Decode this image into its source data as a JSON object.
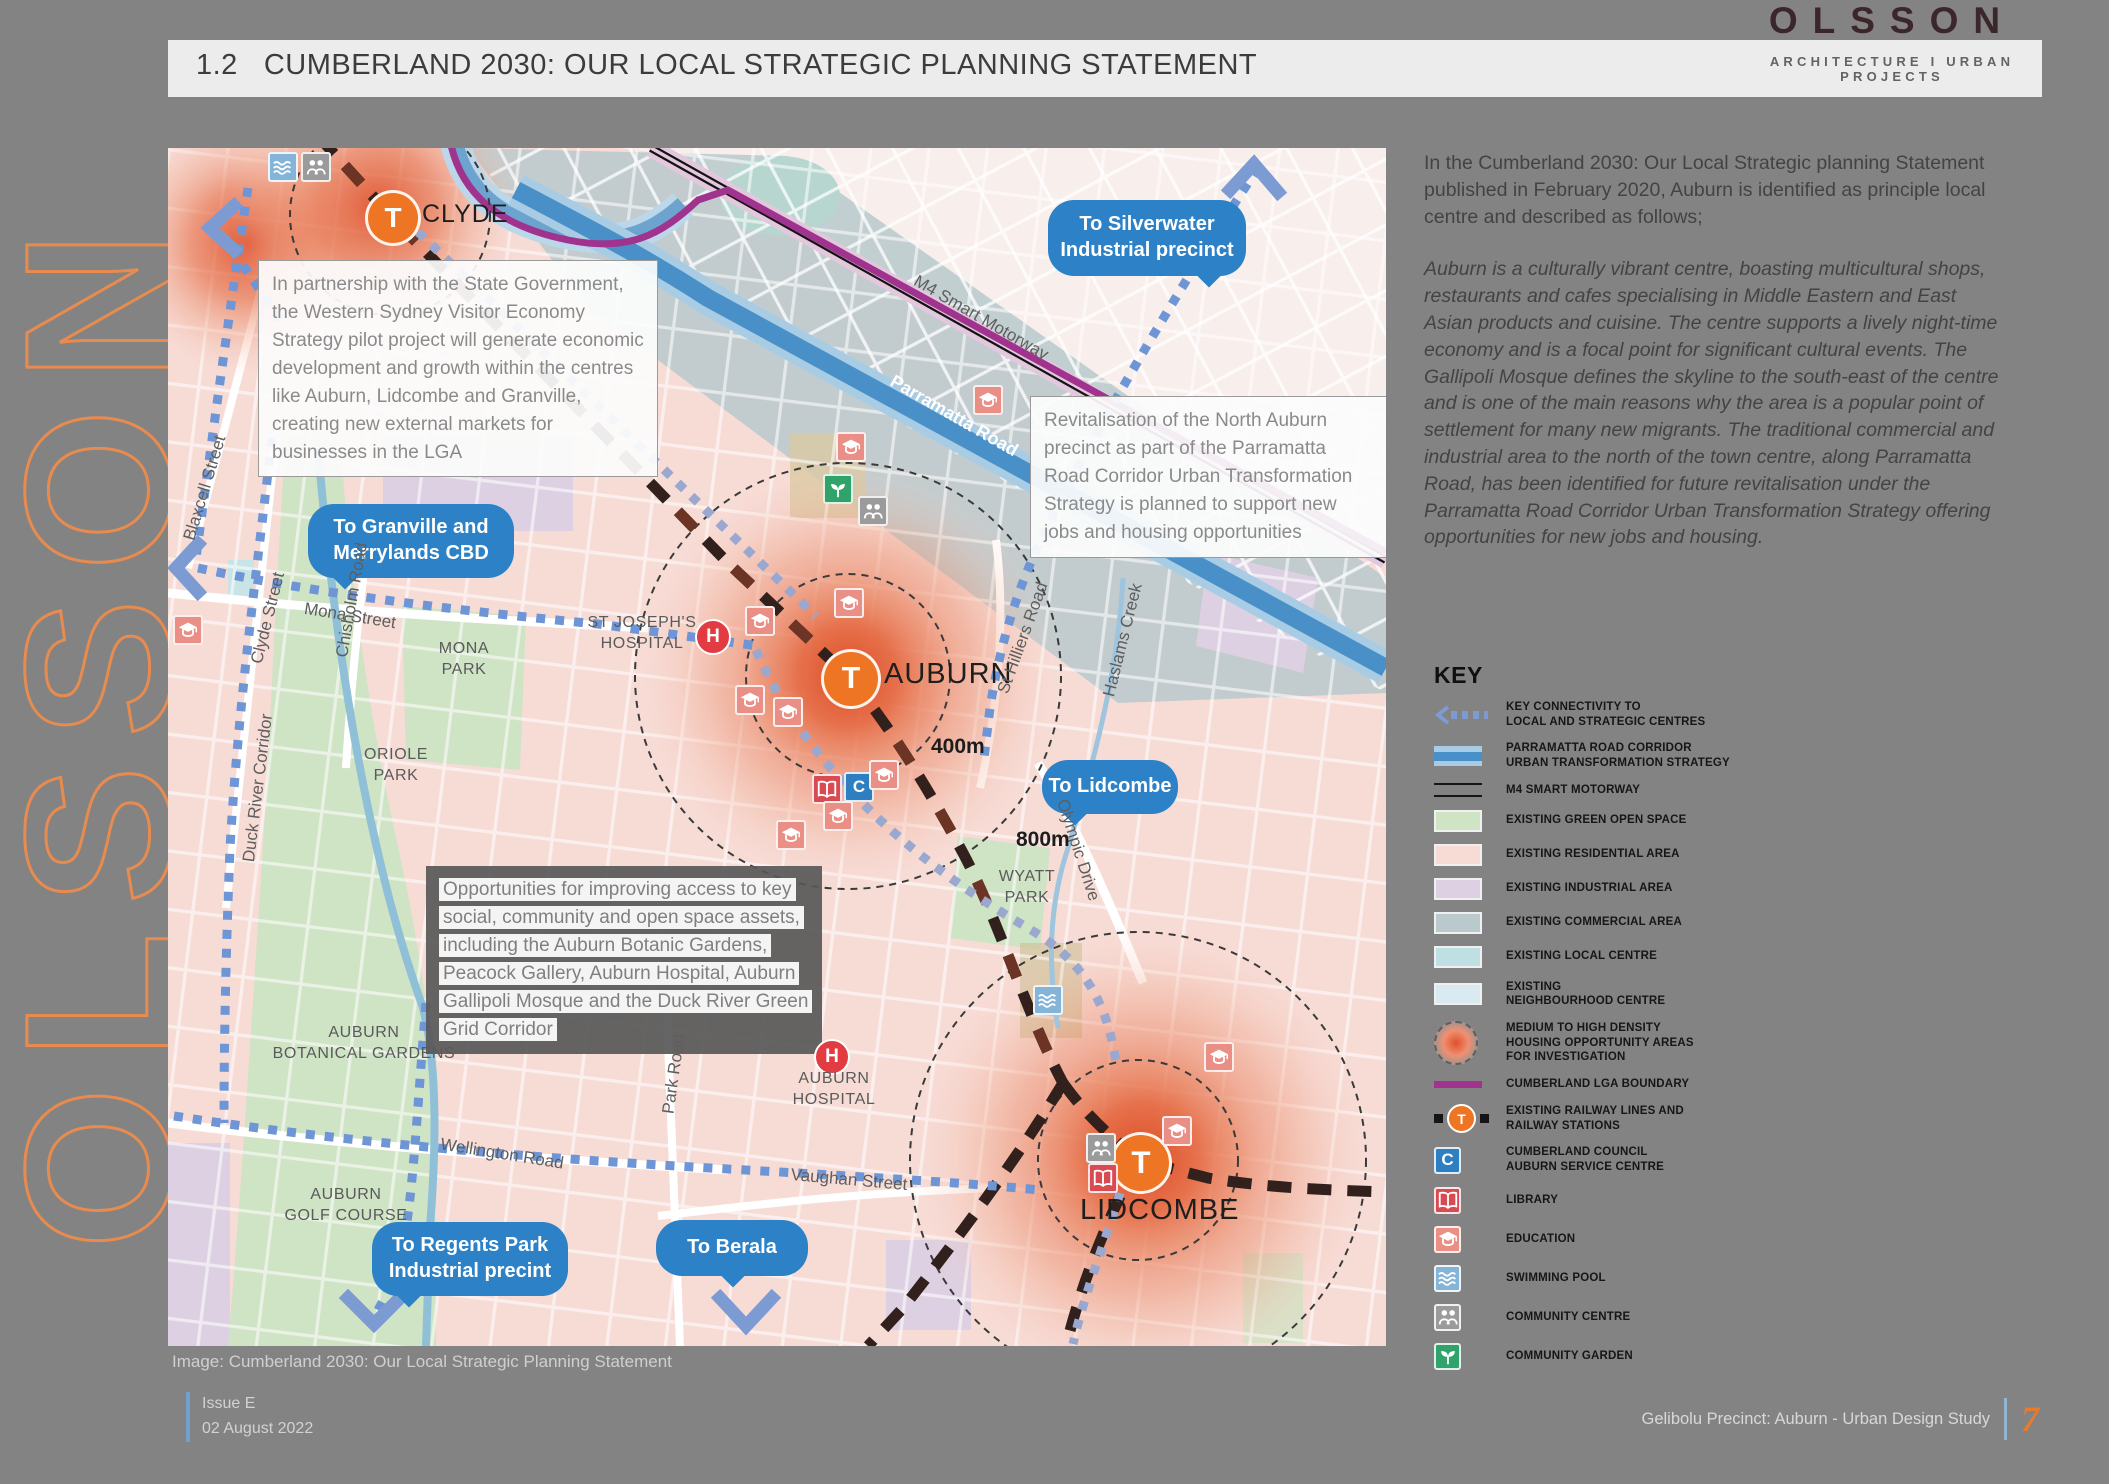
{
  "brand": {
    "logo": "OLSSON",
    "tagline": "ARCHITECTURE I URBAN PROJECTS",
    "vertical_logo": "OLSSON"
  },
  "header": {
    "section_no": "1.2",
    "title": "CUMBERLAND 2030: OUR LOCAL STRATEGIC PLANNING STATEMENT"
  },
  "sidebar": {
    "intro": "In the Cumberland 2030: Our Local Strategic planning Statement published in February 2020, Auburn is identified as principle local centre and described as follows;",
    "quote": "Auburn is a culturally vibrant centre, boasting multicultural shops, restaurants and cafes specialising in Middle Eastern and East Asian products and cuisine. The centre supports a lively night-time economy and is a focal point for significant cultural events. The Gallipoli Mosque defines the skyline to the south-east of the centre and is one of the main reasons why the area is a popular point of settlement for many new migrants. The traditional commercial and industrial area to the north of the town centre, along Parramatta Road, has been identified for future revitalisation under the Parramatta Road Corridor Urban Transformation Strategy offering opportunities for new jobs and housing.",
    "key": {
      "title": "KEY",
      "items": [
        {
          "id": "connectivity",
          "swatch": "connectivity",
          "color": "#7d9bd3",
          "label": "KEY CONNECTIVITY TO\nLOCAL AND STRATEGIC CENTRES"
        },
        {
          "id": "corridor",
          "swatch": "corridor",
          "color": "#4a90c8",
          "label": "PARRAMATTA ROAD CORRIDOR\nURBAN TRANSFORMATION STRATEGY"
        },
        {
          "id": "motorway",
          "swatch": "motorway",
          "color": "#151515",
          "label": "M4 SMART MOTORWAY"
        },
        {
          "id": "green-open-space",
          "swatch": "rect",
          "color": "#cfe3c5",
          "label": "EXISTING GREEN OPEN SPACE"
        },
        {
          "id": "residential",
          "swatch": "rect",
          "color": "#f7dcd6",
          "label": "EXISTING RESIDENTIAL AREA"
        },
        {
          "id": "industrial",
          "swatch": "rect",
          "color": "#ddd0e2",
          "label": "EXISTING INDUSTRIAL AREA"
        },
        {
          "id": "commercial",
          "swatch": "rect",
          "color": "#b9c9cc",
          "label": "EXISTING COMMERCIAL AREA"
        },
        {
          "id": "local-centre",
          "swatch": "rect",
          "color": "#bfe0e3",
          "label": "EXISTING LOCAL CENTRE"
        },
        {
          "id": "neighbourhood-centre",
          "swatch": "rect",
          "color": "#d9ebf0",
          "label": "EXISTING\nNEIGHBOURHOOD CENTRE"
        },
        {
          "id": "housing-opportunity",
          "swatch": "housing",
          "color": "#e0502c",
          "label": "MEDIUM TO HIGH DENSITY\nHOUSING OPPORTUNITY AREAS\nFOR INVESTIGATION"
        },
        {
          "id": "lga-boundary",
          "swatch": "lga",
          "color": "#a0338e",
          "label": "CUMBERLAND LGA BOUNDARY"
        },
        {
          "id": "railway",
          "swatch": "railway",
          "color": "#ee7524",
          "label": "EXISTING RAILWAY LINES AND\nRAILWAY STATIONS"
        },
        {
          "id": "council",
          "swatch": "icon-council",
          "color": "#2e7fc2",
          "label": "CUMBERLAND COUNCIL\nAUBURN SERVICE CENTRE"
        },
        {
          "id": "library",
          "swatch": "icon-library",
          "color": "#d94b52",
          "label": "LIBRARY"
        },
        {
          "id": "education",
          "swatch": "icon-education",
          "color": "#e98f86",
          "label": "EDUCATION"
        },
        {
          "id": "swimming-pool",
          "swatch": "icon-pool",
          "color": "#85b4d9",
          "label": "SWIMMING POOL"
        },
        {
          "id": "community-centre",
          "swatch": "icon-cc",
          "color": "#9b9b9b",
          "label": "COMMUNITY CENTRE"
        },
        {
          "id": "community-garden",
          "swatch": "icon-garden",
          "color": "#2fa36a",
          "label": "COMMUNITY GARDEN"
        }
      ]
    }
  },
  "map": {
    "caption": "Image: Cumberland 2030: Our Local Strategic Planning Statement",
    "stations": [
      {
        "id": "clyde",
        "label": "CLYDE"
      },
      {
        "id": "auburn",
        "label": "AUBURN"
      },
      {
        "id": "lidcombe",
        "label": "LIDCOMBE"
      }
    ],
    "hospitals": [
      {
        "id": "st-josephs",
        "label": "ST JOSEPH'S\nHOSPITAL"
      },
      {
        "id": "auburn-hospital",
        "label": "AUBURN\nHOSPITAL"
      }
    ],
    "areas": [
      {
        "id": "mona-park",
        "label": "MONA\nPARK"
      },
      {
        "id": "oriole-park",
        "label": "ORIOLE\nPARK"
      },
      {
        "id": "botanical",
        "label": "AUBURN\nBOTANICAL GARDENS"
      },
      {
        "id": "golf",
        "label": "AUBURN\nGOLF COURSE"
      },
      {
        "id": "wyatt",
        "label": "WYATT\nPARK"
      }
    ],
    "streets": [
      {
        "id": "blaxcell",
        "label": "Blaxcell Street"
      },
      {
        "id": "clyde-st",
        "label": "Clyde Street"
      },
      {
        "id": "mona-st",
        "label": "Mona Street"
      },
      {
        "id": "chisholm",
        "label": "Chisholm Road"
      },
      {
        "id": "duck-river",
        "label": "Duck River Corridor"
      },
      {
        "id": "wellington",
        "label": "Wellington Road"
      },
      {
        "id": "vaughan",
        "label": "Vaughan Street"
      },
      {
        "id": "park-rd",
        "label": "Park Road"
      },
      {
        "id": "st-hilliers",
        "label": "St Hilliers Road"
      },
      {
        "id": "haslams",
        "label": "Haslams Creek"
      },
      {
        "id": "olympic",
        "label": "Olympic Drive"
      },
      {
        "id": "m4",
        "label": "M4 Smart Motorway"
      },
      {
        "id": "parramatta-rd",
        "label": "Parramatta Road"
      }
    ],
    "radii": [
      {
        "id": "r400",
        "label": "400m"
      },
      {
        "id": "r800",
        "label": "800m"
      }
    ],
    "bubbles": [
      {
        "id": "silverwater",
        "text": "To Silverwater\nIndustrial precinct"
      },
      {
        "id": "granville",
        "text": "To Granville and\nMerrylands CBD"
      },
      {
        "id": "lidcombe",
        "text": "To Lidcombe"
      },
      {
        "id": "regents",
        "text": "To Regents Park\nIndustrial precint"
      },
      {
        "id": "berala",
        "text": "To Berala"
      }
    ],
    "notes": [
      {
        "id": "partnership",
        "style": "light",
        "text": "In partnership with the State Government, the Western Sydney Visitor Economy Strategy pilot project will generate economic development and growth within the centres like Auburn, Lidcombe and Granville, creating new external markets for businesses in the LGA"
      },
      {
        "id": "revitalisation",
        "style": "light",
        "text": "Revitalisation of the North Auburn precinct as part of the Parramatta Road Corridor Urban Transformation Strategy is planned to support new jobs and housing opportunities"
      },
      {
        "id": "opportunities",
        "style": "dark",
        "text": "Opportunities for improving access to key social, community and open space assets, including the Auburn Botanic Gardens, Peacock Gallery, Auburn Hospital, Auburn Gallipoli Mosque and the Duck River Green Grid Corridor"
      }
    ]
  },
  "footer": {
    "issue": "Issue E\n02 August 2022",
    "doc_title": "Gelibolu Precinct: Auburn - Urban Design Study",
    "page_number": "7"
  },
  "colors": {
    "accent_orange": "#ee7524",
    "bubble_blue": "#2d82c7",
    "corridor_blue": "#4a90c8",
    "lga_purple": "#a0338e",
    "page_gray": "#838383",
    "band_gray": "#ececec",
    "logo_maroon": "#3b262b",
    "residential_pink": "#f7dcd6",
    "green_open_space": "#cfe3c5",
    "industrial_lavender": "#ddd0e2",
    "commercial_gray": "#b9c9cc",
    "hotspot_red": "#e0502c",
    "railway_dark": "#33201d",
    "vertical_brand_orange": "#ee8c4d"
  }
}
